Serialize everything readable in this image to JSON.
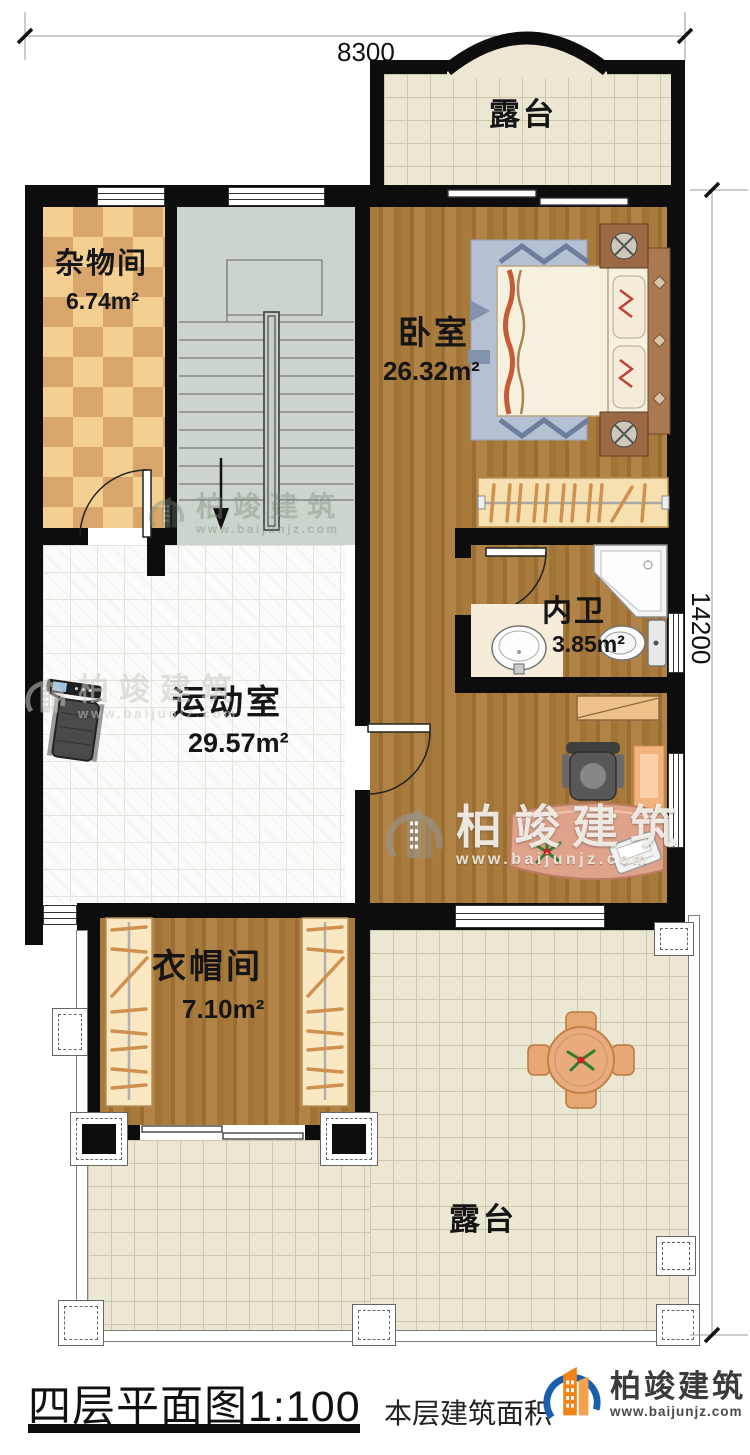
{
  "dimensions": {
    "width_mm": "8300",
    "height_mm": "14200"
  },
  "rooms": [
    {
      "key": "terrace-top",
      "name": "露台",
      "area": ""
    },
    {
      "key": "storage",
      "name": "杂物间",
      "area": "6.74m²"
    },
    {
      "key": "bedroom",
      "name": "卧室",
      "area": "26.32m²"
    },
    {
      "key": "bathroom",
      "name": "内卫",
      "area": "3.85m²"
    },
    {
      "key": "gym",
      "name": "运动室",
      "area": "29.57m²"
    },
    {
      "key": "cloakroom",
      "name": "衣帽间",
      "area": "7.10m²"
    },
    {
      "key": "terrace-bottom",
      "name": "露台",
      "area": ""
    }
  ],
  "footer": {
    "plan_title": "四层平面图",
    "plan_scale": "1:100",
    "area_note": "本层建筑面积",
    "brand_name": "柏竣建筑",
    "brand_site": "www.baijunjz.com"
  },
  "watermark": {
    "brand_name": "柏竣建筑",
    "brand_site": "www.baijunjz.com"
  },
  "colors": {
    "wall": "#0d0d0d",
    "wood": "#a87a3c",
    "terrace_tile": "#ece7d3",
    "checker_light": "#f3cf92",
    "checker_dark": "#d8a66b",
    "stair": "#ccd5cb",
    "brand_orange": "#f08418",
    "brand_blue": "#1a5fae"
  }
}
